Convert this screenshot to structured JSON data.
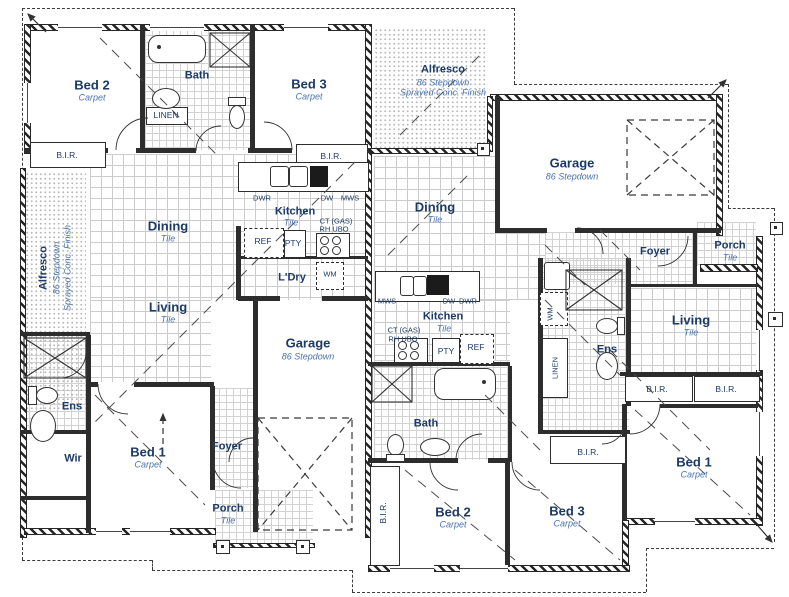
{
  "colors": {
    "wall": "#2d2d2d",
    "room_label": "#1c3a66",
    "finish_label": "#4a74ad",
    "tile_grid": "#cccccc",
    "boundary": "#3c3c3c"
  },
  "labels": [
    {
      "name": "room-bed2-left",
      "text": "Bed 2",
      "x": 92,
      "y": 85,
      "cls": "room"
    },
    {
      "name": "finish-bed2-left",
      "text": "Carpet",
      "x": 92,
      "y": 98,
      "cls": "sub"
    },
    {
      "name": "room-bath-left",
      "text": "Bath",
      "x": 197,
      "y": 76,
      "cls": "room-sm"
    },
    {
      "name": "closet-linen-left",
      "text": "LINEN",
      "x": 166,
      "y": 115,
      "cls": "fix"
    },
    {
      "name": "closet-bir-bed2-left",
      "text": "B.I.R.",
      "x": 67,
      "y": 155,
      "cls": "fix"
    },
    {
      "name": "room-bed3-left",
      "text": "Bed 3",
      "x": 309,
      "y": 84,
      "cls": "room"
    },
    {
      "name": "finish-bed3-left",
      "text": "Carpet",
      "x": 309,
      "y": 97,
      "cls": "sub"
    },
    {
      "name": "closet-bir-bed3-left",
      "text": "B.I.R.",
      "x": 331,
      "y": 156,
      "cls": "fix"
    },
    {
      "name": "room-alfresco-left",
      "text": "Alfresco",
      "x": 44,
      "y": 268,
      "cls": "room-sm",
      "rot": 1
    },
    {
      "name": "sub-alfresco-left-1",
      "text": "86 Stepdown",
      "x": 57,
      "y": 268,
      "cls": "sub",
      "rot": 1
    },
    {
      "name": "sub-alfresco-left-2",
      "text": "Sprayed Conc. Finish",
      "x": 68,
      "y": 268,
      "cls": "sub",
      "rot": 1
    },
    {
      "name": "room-dining-left",
      "text": "Dining",
      "x": 168,
      "y": 226,
      "cls": "room"
    },
    {
      "name": "finish-dining-left",
      "text": "Tile",
      "x": 168,
      "y": 239,
      "cls": "sub"
    },
    {
      "name": "room-living-left",
      "text": "Living",
      "x": 168,
      "y": 307,
      "cls": "room"
    },
    {
      "name": "finish-living-left",
      "text": "Tile",
      "x": 168,
      "y": 320,
      "cls": "sub"
    },
    {
      "name": "room-kitchen-left",
      "text": "Kitchen",
      "x": 295,
      "y": 212,
      "cls": "room-sm"
    },
    {
      "name": "finish-kitchen-left",
      "text": "Tile",
      "x": 291,
      "y": 223,
      "cls": "sub"
    },
    {
      "name": "fix-dwr-left",
      "text": "DWR",
      "x": 262,
      "y": 198,
      "cls": "tiny"
    },
    {
      "name": "fix-dw-left",
      "text": "DW",
      "x": 327,
      "y": 198,
      "cls": "tiny"
    },
    {
      "name": "fix-mws-left",
      "text": "MWS",
      "x": 350,
      "y": 198,
      "cls": "tiny"
    },
    {
      "name": "fix-ctgas-left",
      "text": "CT (GAS)",
      "x": 336,
      "y": 221,
      "cls": "tiny"
    },
    {
      "name": "fix-rhubo-left",
      "text": "RH UBO",
      "x": 334,
      "y": 229,
      "cls": "tiny"
    },
    {
      "name": "fix-ref-left",
      "text": "REF",
      "x": 263,
      "y": 241,
      "cls": "fix"
    },
    {
      "name": "fix-pty-left",
      "text": "PTY",
      "x": 293,
      "y": 243,
      "cls": "fix"
    },
    {
      "name": "room-ldry-left",
      "text": "L'Dry",
      "x": 292,
      "y": 278,
      "cls": "room-sm"
    },
    {
      "name": "fix-wm-left",
      "text": "WM",
      "x": 330,
      "y": 274,
      "cls": "tiny"
    },
    {
      "name": "room-garage-left",
      "text": "Garage",
      "x": 308,
      "y": 343,
      "cls": "room"
    },
    {
      "name": "sub-garage-left",
      "text": "86 Stepdown",
      "x": 308,
      "y": 357,
      "cls": "sub"
    },
    {
      "name": "room-ens-left",
      "text": "Ens",
      "x": 72,
      "y": 407,
      "cls": "room-sm"
    },
    {
      "name": "room-wir-left",
      "text": "Wir",
      "x": 73,
      "y": 459,
      "cls": "room-sm"
    },
    {
      "name": "room-bed1-left",
      "text": "Bed 1",
      "x": 148,
      "y": 452,
      "cls": "room"
    },
    {
      "name": "finish-bed1-left",
      "text": "Carpet",
      "x": 148,
      "y": 465,
      "cls": "sub"
    },
    {
      "name": "room-foyer-left",
      "text": "Foyer",
      "x": 227,
      "y": 447,
      "cls": "room-sm"
    },
    {
      "name": "room-porch-left",
      "text": "Porch",
      "x": 228,
      "y": 509,
      "cls": "room-sm"
    },
    {
      "name": "finish-porch-left",
      "text": "Tile",
      "x": 228,
      "y": 521,
      "cls": "sub"
    },
    {
      "name": "room-alfresco-right",
      "text": "Alfresco",
      "x": 443,
      "y": 70,
      "cls": "room-sm"
    },
    {
      "name": "sub-alfresco-right-1",
      "text": "86 Stepdown",
      "x": 443,
      "y": 83,
      "cls": "sub"
    },
    {
      "name": "sub-alfresco-right-2",
      "text": "Sprayed Conc. Finish",
      "x": 443,
      "y": 93,
      "cls": "sub"
    },
    {
      "name": "room-garage-right",
      "text": "Garage",
      "x": 572,
      "y": 163,
      "cls": "room"
    },
    {
      "name": "sub-garage-right",
      "text": "86 Stepdown",
      "x": 572,
      "y": 177,
      "cls": "sub"
    },
    {
      "name": "room-dining-right",
      "text": "Dining",
      "x": 435,
      "y": 207,
      "cls": "room"
    },
    {
      "name": "finish-dining-right",
      "text": "Tile",
      "x": 435,
      "y": 220,
      "cls": "sub"
    },
    {
      "name": "room-foyer-right",
      "text": "Foyer",
      "x": 655,
      "y": 252,
      "cls": "room-sm"
    },
    {
      "name": "room-porch-right",
      "text": "Porch",
      "x": 730,
      "y": 246,
      "cls": "room-sm"
    },
    {
      "name": "finish-porch-right",
      "text": "Tile",
      "x": 730,
      "y": 258,
      "cls": "sub"
    },
    {
      "name": "fix-mws-right",
      "text": "MWS",
      "x": 387,
      "y": 301,
      "cls": "tiny"
    },
    {
      "name": "fix-dw-right",
      "text": "DW",
      "x": 449,
      "y": 301,
      "cls": "tiny"
    },
    {
      "name": "fix-dwr-right",
      "text": "DWR",
      "x": 468,
      "y": 301,
      "cls": "tiny"
    },
    {
      "name": "room-kitchen-right",
      "text": "Kitchen",
      "x": 443,
      "y": 317,
      "cls": "room-sm"
    },
    {
      "name": "finish-kitchen-right",
      "text": "Tile",
      "x": 444,
      "y": 329,
      "cls": "sub"
    },
    {
      "name": "fix-ctgas-right",
      "text": "CT (GAS)",
      "x": 404,
      "y": 330,
      "cls": "tiny"
    },
    {
      "name": "fix-rhubo-right",
      "text": "RH UBO",
      "x": 403,
      "y": 339,
      "cls": "tiny"
    },
    {
      "name": "fix-pty-right",
      "text": "PTY",
      "x": 446,
      "y": 351,
      "cls": "fix"
    },
    {
      "name": "fix-ref-right",
      "text": "REF",
      "x": 476,
      "y": 347,
      "cls": "fix"
    },
    {
      "name": "fix-wm-right",
      "text": "WM",
      "x": 550,
      "y": 314,
      "cls": "tiny",
      "rot": 1
    },
    {
      "name": "closet-linen-right",
      "text": "LINEN",
      "x": 555,
      "y": 368,
      "cls": "tiny",
      "rot": 1
    },
    {
      "name": "room-ens-right",
      "text": "Ens",
      "x": 607,
      "y": 350,
      "cls": "room-sm"
    },
    {
      "name": "room-living-right",
      "text": "Living",
      "x": 691,
      "y": 320,
      "cls": "room"
    },
    {
      "name": "finish-living-right",
      "text": "Tile",
      "x": 691,
      "y": 333,
      "cls": "sub"
    },
    {
      "name": "closet-bir-living-right-1",
      "text": "B.I.R.",
      "x": 657,
      "y": 389,
      "cls": "fix"
    },
    {
      "name": "closet-bir-living-right-2",
      "text": "B.I.R.",
      "x": 726,
      "y": 389,
      "cls": "fix"
    },
    {
      "name": "room-bath-right",
      "text": "Bath",
      "x": 426,
      "y": 424,
      "cls": "room-sm"
    },
    {
      "name": "closet-bir-bed2-right",
      "text": "B.I.R.",
      "x": 383,
      "y": 513,
      "cls": "fix",
      "rot": 1
    },
    {
      "name": "room-bed2-right",
      "text": "Bed 2",
      "x": 453,
      "y": 512,
      "cls": "room"
    },
    {
      "name": "finish-bed2-right",
      "text": "Carpet",
      "x": 453,
      "y": 525,
      "cls": "sub"
    },
    {
      "name": "room-bed3-right",
      "text": "Bed 3",
      "x": 567,
      "y": 511,
      "cls": "room"
    },
    {
      "name": "finish-bed3-right",
      "text": "Carpet",
      "x": 567,
      "y": 524,
      "cls": "sub"
    },
    {
      "name": "closet-bir-bed3-right",
      "text": "B.I.R.",
      "x": 588,
      "y": 452,
      "cls": "fix"
    },
    {
      "name": "room-bed1-right",
      "text": "Bed 1",
      "x": 694,
      "y": 462,
      "cls": "room"
    },
    {
      "name": "finish-bed1-right",
      "text": "Carpet",
      "x": 694,
      "y": 475,
      "cls": "sub"
    }
  ]
}
